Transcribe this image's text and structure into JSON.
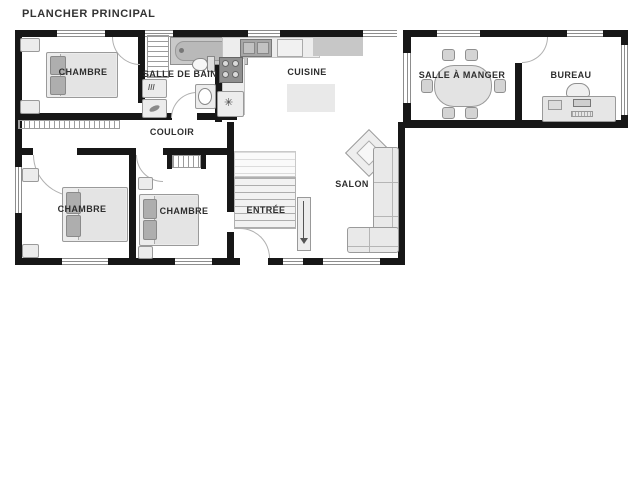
{
  "title": "PLANCHER PRINCIPAL",
  "rooms": {
    "bedroom1": {
      "label": "CHAMBRE"
    },
    "bathroom": {
      "label": "SALLE DE BAIN"
    },
    "kitchen": {
      "label": "CUISINE"
    },
    "dining": {
      "label": "SALLE À MANGER"
    },
    "office": {
      "label": "BUREAU"
    },
    "hallway": {
      "label": "COULOIR"
    },
    "bedroom2": {
      "label": "CHAMBRE"
    },
    "bedroom3": {
      "label": "CHAMBRE"
    },
    "entry": {
      "label": "ENTRÉE"
    },
    "living": {
      "label": "SALON"
    }
  },
  "icons": {
    "fridge_glyph": "✳",
    "dryer_glyph": "///"
  },
  "colors": {
    "wall": "#171717",
    "furniture_fill": "#ececec",
    "furniture_stroke": "#9a9a9a",
    "dark_gray": "#a6a6a6",
    "counter_dark": "#c7c7c7",
    "text": "#2e2e2e",
    "background": "#ffffff"
  }
}
